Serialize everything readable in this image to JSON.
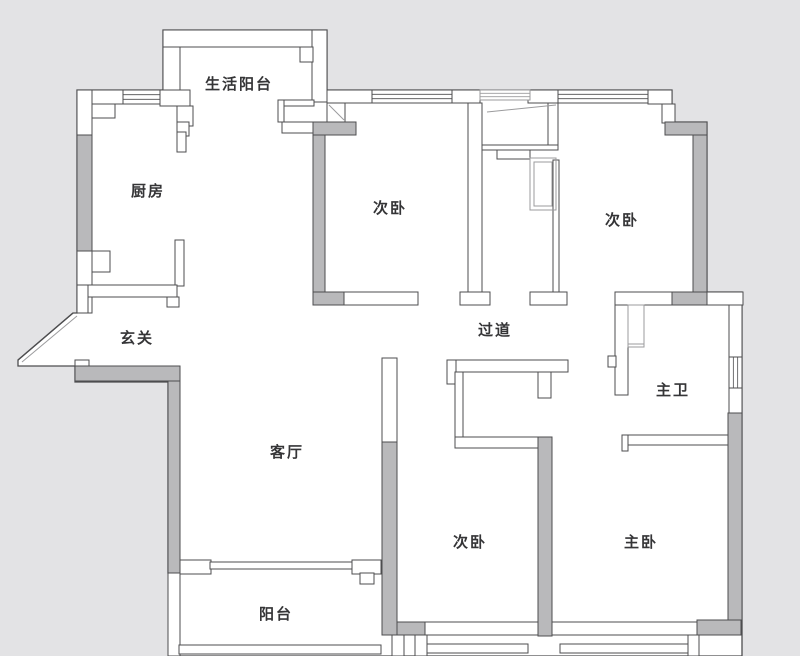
{
  "canvas": {
    "w": 800,
    "h": 656,
    "bg": "#e3e3e5",
    "floor": "#ffffff",
    "wall_fill": "#b9b9bb",
    "stroke": "#4d4d4f",
    "light": "#9b9b9d",
    "text": "#353537"
  },
  "rooms": [
    {
      "id": "utility-balcony",
      "label": "生活阳台",
      "x": 239,
      "y": 84
    },
    {
      "id": "kitchen",
      "label": "厨房",
      "x": 148,
      "y": 191
    },
    {
      "id": "bedroom-2a",
      "label": "次卧",
      "x": 390,
      "y": 208
    },
    {
      "id": "bedroom-2b",
      "label": "次卧",
      "x": 622,
      "y": 220
    },
    {
      "id": "entry",
      "label": "玄关",
      "x": 137,
      "y": 338
    },
    {
      "id": "corridor",
      "label": "过道",
      "x": 495,
      "y": 330
    },
    {
      "id": "master-bath",
      "label": "主卫",
      "x": 673,
      "y": 390
    },
    {
      "id": "living-room",
      "label": "客厅",
      "x": 287,
      "y": 452
    },
    {
      "id": "bedroom-2c",
      "label": "次卧",
      "x": 470,
      "y": 542
    },
    {
      "id": "master-bedroom",
      "label": "主卧",
      "x": 641,
      "y": 542
    },
    {
      "id": "balcony",
      "label": "阳台",
      "x": 276,
      "y": 614
    }
  ],
  "floorplan": {
    "footprint": "77,90 163,90 163,30 327,30 327,90 672,90 672,122 707,122 707,292 742,292 742,656 179,656 179,573 168,573 168,382 75,382 75,366 18,366 18,360 73,313 77,313",
    "walls_white": [
      {
        "n": "kitchen-north-wall",
        "r": [
          77,
          90,
          46,
          14
        ]
      },
      {
        "n": "kitchen-north-corner",
        "r": [
          160,
          90,
          30,
          16
        ]
      },
      {
        "n": "kitchen-west-wall-top",
        "r": [
          77,
          90,
          15,
          47
        ]
      },
      {
        "n": "kitchen-west-wall-bottom",
        "r": [
          77,
          251,
          15,
          62
        ]
      },
      {
        "n": "kitchen-pillar-top",
        "r": [
          92,
          104,
          23,
          14
        ]
      },
      {
        "n": "kitchen-pillar-bottom",
        "r": [
          92,
          251,
          18,
          21
        ]
      },
      {
        "n": "kitchen-door-step-1",
        "r": [
          177,
          106,
          16,
          20
        ]
      },
      {
        "n": "kitchen-door-step-2",
        "r": [
          177,
          122,
          12,
          14
        ]
      },
      {
        "n": "kitchen-east-wall-upper",
        "r": [
          177,
          132,
          9,
          20
        ]
      },
      {
        "n": "kitchen-east-wall-lower",
        "r": [
          175,
          240,
          9,
          46
        ]
      },
      {
        "n": "kitchen-south-bar",
        "r": [
          87,
          285,
          90,
          12
        ]
      },
      {
        "n": "kitchen-south-leg-west",
        "r": [
          77,
          285,
          11,
          28
        ]
      },
      {
        "n": "kitchen-south-leg-east",
        "r": [
          167,
          297,
          12,
          10
        ]
      },
      {
        "n": "utility-balcony-west-wall",
        "r": [
          163,
          30,
          17,
          60
        ]
      },
      {
        "n": "utility-balcony-north-wall",
        "r": [
          163,
          30,
          164,
          17
        ]
      },
      {
        "n": "utility-balcony-east-wall",
        "r": [
          312,
          30,
          15,
          72
        ]
      },
      {
        "n": "utility-balcony-step",
        "r": [
          300,
          47,
          13,
          15
        ]
      },
      {
        "n": "utility-balcony-south-bar",
        "r": [
          278,
          100,
          36,
          6
        ]
      },
      {
        "n": "utility-balcony-south-stub",
        "r": [
          278,
          100,
          6,
          22
        ]
      },
      {
        "n": "bedroom1-north-ledge",
        "r": [
          282,
          122,
          31,
          11
        ]
      },
      {
        "n": "bedroom1-door-box",
        "r": [
          327,
          103,
          18,
          19
        ]
      },
      {
        "n": "top-wall-segment-1",
        "r": [
          327,
          90,
          45,
          13
        ]
      },
      {
        "n": "top-wall-pillar-1",
        "r": [
          450,
          90,
          30,
          13
        ]
      },
      {
        "n": "top-wall-pillar-2",
        "r": [
          528,
          90,
          30,
          13
        ]
      },
      {
        "n": "top-wall-ne-corner",
        "r": [
          648,
          90,
          24,
          14
        ]
      },
      {
        "n": "ne-corner-step",
        "r": [
          662,
          104,
          13,
          19
        ]
      },
      {
        "n": "bedroom-divider-wall",
        "r": [
          468,
          103,
          14,
          189
        ]
      },
      {
        "n": "bedroom-divider-base",
        "r": [
          460,
          292,
          30,
          13
        ]
      },
      {
        "n": "niche-east-wall",
        "r": [
          548,
          103,
          10,
          45
        ]
      },
      {
        "n": "niche-south-line",
        "r": [
          482,
          145,
          76,
          5
        ]
      },
      {
        "n": "niche-sill",
        "r": [
          497,
          150,
          33,
          9
        ]
      },
      {
        "n": "bedroom2-west-wall",
        "r": [
          553,
          160,
          6,
          132
        ]
      },
      {
        "n": "bedroom2-door-base",
        "r": [
          530,
          292,
          37,
          13
        ]
      },
      {
        "n": "bedroom1-south-wall",
        "r": [
          343,
          292,
          75,
          13
        ]
      },
      {
        "n": "bath-north-wall-west",
        "r": [
          615,
          292,
          58,
          13
        ]
      },
      {
        "n": "bath-north-wall-east",
        "r": [
          707,
          292,
          36,
          13
        ]
      },
      {
        "n": "bath-west-wall",
        "r": [
          615,
          305,
          13,
          90
        ]
      },
      {
        "n": "bath-west-notch",
        "r": [
          608,
          356,
          8,
          11
        ]
      },
      {
        "n": "bath-south-wall",
        "r": [
          622,
          435,
          109,
          10
        ]
      },
      {
        "n": "bath-south-stub",
        "r": [
          622,
          435,
          6,
          16
        ]
      },
      {
        "n": "bath-east-wall-upper",
        "r": [
          729,
          305,
          13,
          52
        ]
      },
      {
        "n": "bath-east-wall-lower",
        "r": [
          729,
          388,
          13,
          26
        ]
      },
      {
        "n": "closet-north-bar",
        "r": [
          447,
          360,
          121,
          12
        ]
      },
      {
        "n": "closet-nw-flare",
        "r": [
          447,
          360,
          9,
          24
        ]
      },
      {
        "n": "closet-ne-stub",
        "r": [
          538,
          372,
          13,
          26
        ]
      },
      {
        "n": "closet-west-wall",
        "r": [
          455,
          372,
          8,
          72
        ]
      },
      {
        "n": "closet-south-bar",
        "r": [
          455,
          437,
          86,
          11
        ]
      },
      {
        "n": "living-bedroom-wall-top",
        "r": [
          382,
          358,
          15,
          84
        ]
      },
      {
        "n": "balcony-door-wall-west",
        "r": [
          180,
          560,
          31,
          14
        ]
      },
      {
        "n": "balcony-door-wall-east",
        "r": [
          352,
          560,
          29,
          14
        ]
      },
      {
        "n": "balcony-sliding-door",
        "r": [
          210,
          562,
          142,
          7
        ]
      },
      {
        "n": "balcony-door-step",
        "r": [
          360,
          573,
          14,
          11
        ]
      },
      {
        "n": "balcony-west-wall",
        "r": [
          168,
          573,
          12,
          83
        ]
      },
      {
        "n": "balcony-south-rail",
        "r": [
          179,
          645,
          202,
          9
        ]
      },
      {
        "n": "bedroom3-south-wall",
        "r": [
          425,
          622,
          113,
          13
        ]
      },
      {
        "n": "master-south-wall",
        "r": [
          552,
          622,
          146,
          13
        ]
      },
      {
        "n": "bay-post-1",
        "r": [
          392,
          635,
          12,
          21
        ]
      },
      {
        "n": "bay-post-2",
        "r": [
          415,
          635,
          12,
          21
        ]
      },
      {
        "n": "bay-post-3",
        "r": [
          688,
          635,
          11,
          21
        ]
      },
      {
        "n": "bay-rail-1",
        "r": [
          427,
          644,
          101,
          9
        ]
      },
      {
        "n": "bay-rail-2",
        "r": [
          560,
          644,
          128,
          9
        ]
      },
      {
        "n": "entry-step",
        "r": [
          75,
          360,
          14,
          9
        ]
      }
    ],
    "walls_gray": [
      {
        "n": "kitchen-west-wall-fill",
        "r": [
          77,
          135,
          15,
          116
        ]
      },
      {
        "n": "bedroom1-west-wall-fill",
        "r": [
          313,
          122,
          12,
          170
        ]
      },
      {
        "n": "bedroom1-nw-bar-fill",
        "r": [
          313,
          122,
          43,
          13
        ]
      },
      {
        "n": "bedroom1-sw-bar-fill",
        "r": [
          313,
          292,
          31,
          13
        ]
      },
      {
        "n": "bedroom2-east-wall-fill",
        "r": [
          693,
          135,
          14,
          158
        ]
      },
      {
        "n": "bedroom2-ne-bar-fill",
        "r": [
          665,
          122,
          42,
          13
        ]
      },
      {
        "n": "bedroom2-se-bar-fill",
        "r": [
          672,
          292,
          35,
          13
        ]
      },
      {
        "n": "entry-south-wall-fill",
        "r": [
          75,
          366,
          105,
          15
        ]
      },
      {
        "n": "living-west-wall-fill",
        "r": [
          168,
          381,
          12,
          192
        ]
      },
      {
        "n": "living-bedroom3-wall-fill",
        "r": [
          382,
          442,
          15,
          193
        ]
      },
      {
        "n": "bedroom3-sw-bar-fill",
        "r": [
          397,
          622,
          28,
          13
        ]
      },
      {
        "n": "bedroom3-master-wall-fill",
        "r": [
          538,
          437,
          14,
          199
        ]
      },
      {
        "n": "master-east-wall-fill",
        "r": [
          728,
          413,
          14,
          207
        ]
      },
      {
        "n": "master-se-corner-fill",
        "r": [
          697,
          620,
          44,
          15
        ]
      }
    ],
    "windows": [
      {
        "n": "kitchen-window",
        "r": [
          123,
          90,
          37,
          14
        ],
        "o": "h"
      },
      {
        "n": "bedroom1-window",
        "r": [
          372,
          90,
          80,
          13
        ],
        "o": "h"
      },
      {
        "n": "niche-window",
        "r": [
          480,
          90,
          50,
          10
        ],
        "o": "h",
        "light": true
      },
      {
        "n": "bedroom2-window",
        "r": [
          558,
          90,
          90,
          13
        ],
        "o": "h"
      },
      {
        "n": "bath-window",
        "r": [
          729,
          357,
          13,
          31
        ],
        "o": "v"
      }
    ],
    "details": [
      {
        "n": "wardrobe-outer",
        "r": [
          530,
          158,
          26,
          52
        ]
      },
      {
        "n": "wardrobe-inner",
        "r": [
          534,
          162,
          18,
          44
        ]
      },
      {
        "n": "shower-screen",
        "r": [
          628,
          305,
          16,
          42
        ]
      }
    ],
    "lines": [
      {
        "n": "entry-diagonal-outer",
        "p": [
          73,
          313,
          18,
          360
        ],
        "c": "dark",
        "w": 1.4
      },
      {
        "n": "entry-diagonal-inner",
        "p": [
          77,
          316,
          22,
          362
        ],
        "c": "light",
        "w": 1
      },
      {
        "n": "niche-diagonal",
        "p": [
          487,
          112,
          556,
          105
        ],
        "c": "light",
        "w": 1
      },
      {
        "n": "bedroom1-door-swing",
        "p": [
          329,
          105,
          344,
          120
        ],
        "c": "light",
        "w": 1
      },
      {
        "n": "shower-base-line",
        "p": [
          628,
          344,
          644,
          344
        ],
        "c": "light",
        "w": 1
      }
    ]
  }
}
